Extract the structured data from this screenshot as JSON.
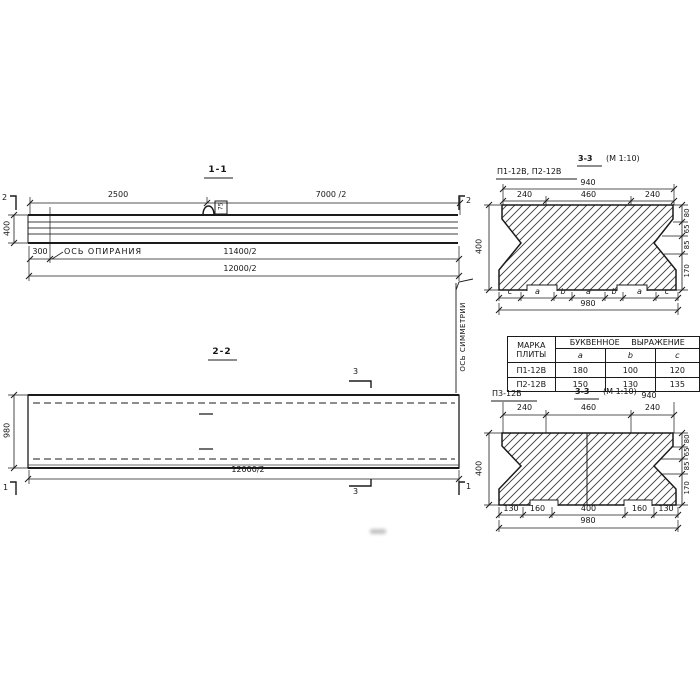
{
  "drawing": {
    "elevation": {
      "title": "1-1",
      "cut_left": "2",
      "cut_right": "2",
      "dim_2500": "2500",
      "dim_7000": "7000 /2",
      "dim_height": "400",
      "dim_300": "300",
      "bearing_axis_label": "ОСЬ ОПИРАНИЯ",
      "dim_11400": "11400/2",
      "dim_12000": "12000/2",
      "loop_label": "75"
    },
    "plan": {
      "title": "2-2",
      "dim_width": "980",
      "dim_12000": "12000/2",
      "cut_3_top": "3",
      "cut_3_bottom": "3",
      "cut_1_left": "1",
      "cut_1_right": "1"
    },
    "symmetry_axis_label": "ОСЬ СИММЕТРИИ",
    "section_top": {
      "plate_label": "П1-12В, П2-12В",
      "title": "3-3",
      "scale": "(М 1:10)",
      "dim_940": "940",
      "dim_240_left": "240",
      "dim_460": "460",
      "dim_240_right": "240",
      "dim_400": "400",
      "right_dims": [
        "80",
        "65",
        "85",
        "170"
      ],
      "letters": [
        "c",
        "a",
        "b",
        "a",
        "b",
        "a",
        "c"
      ],
      "dim_980": "980"
    },
    "table": {
      "col_mark_line1": "МАРКА",
      "col_mark_line2": "ПЛИТЫ",
      "header_expression": "БУКВЕННОЕ ВЫРАЖЕНИЕ",
      "col_a": "a",
      "col_b": "b",
      "col_c": "c",
      "rows": [
        {
          "mark": "П1-12В",
          "a": "180",
          "b": "100",
          "c": "120"
        },
        {
          "mark": "П2-12В",
          "a": "150",
          "b": "130",
          "c": "135"
        }
      ]
    },
    "section_bottom": {
      "plate_label": "П3-12В",
      "title": "3-3",
      "scale": "(М 1:10)",
      "dim_940": "940",
      "dim_240_left": "240",
      "dim_460": "460",
      "dim_240_right": "240",
      "dim_400": "400",
      "right_dims": [
        "80",
        "65",
        "85",
        "170"
      ],
      "bottom_dims": [
        "130",
        "160",
        "400",
        "160",
        "130"
      ],
      "dim_980": "980"
    }
  }
}
